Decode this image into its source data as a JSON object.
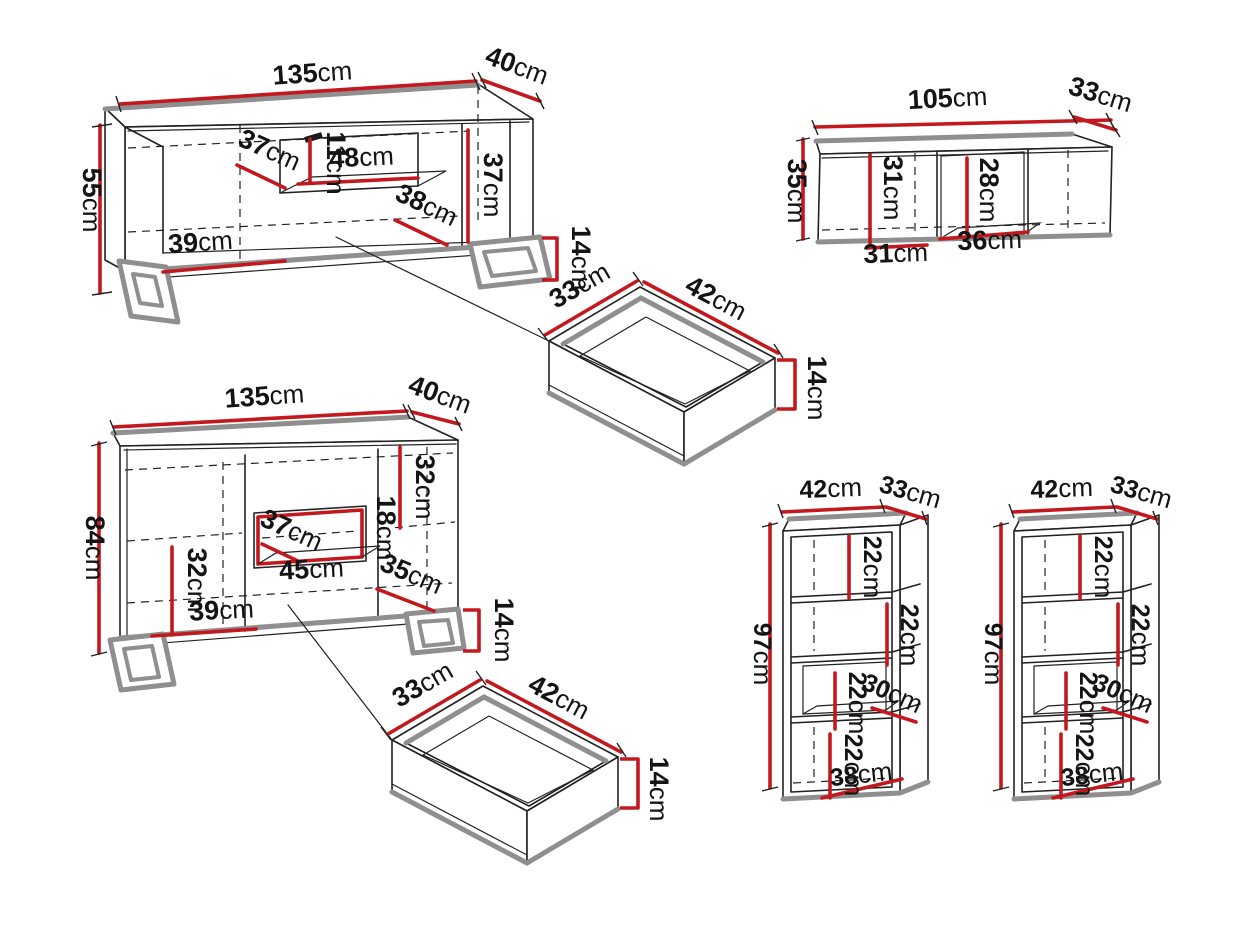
{
  "units": "cm",
  "colors": {
    "dimension_red": "#c3191e",
    "edge_gray": "#8f8f8f",
    "line_black": "#222222",
    "background": "#ffffff"
  },
  "pieces": {
    "tv_stand": {
      "width": "135",
      "depth": "40",
      "height": "55",
      "left_door_width": "37",
      "niche_height": "11",
      "niche_width": "48",
      "right_inner_height": "37",
      "right_door_width": "38",
      "left_inner_width": "39",
      "leg_height": "14"
    },
    "wall_cabinet": {
      "width": "105",
      "depth": "33",
      "height": "35",
      "left_inner_height": "31",
      "middle_inner_height": "28",
      "left_inner_width": "31",
      "middle_inner_width": "36"
    },
    "drawer_top": {
      "depth": "33",
      "width": "42",
      "height": "14"
    },
    "sideboard": {
      "width": "135",
      "depth": "40",
      "height": "84",
      "right_inner_height": "32",
      "niche_height": "18",
      "niche_inner_width": "37",
      "niche_width": "45",
      "right_door_width": "35",
      "left_inner_height": "32",
      "left_inner_width": "39",
      "leg_height": "14"
    },
    "drawer_bottom": {
      "depth": "33",
      "width": "42",
      "height": "14"
    },
    "bookcase_left": {
      "width": "42",
      "depth": "33",
      "height": "97",
      "compartment_1_height": "22",
      "compartment_2_height": "22",
      "compartment_3_height": "22",
      "inner_width": "30",
      "compartment_4_height": "22",
      "bottom_inner_width": "38"
    },
    "bookcase_right": {
      "width": "42",
      "depth": "33",
      "height": "97",
      "compartment_1_height": "22",
      "compartment_2_height": "22",
      "compartment_3_height": "22",
      "inner_width": "30",
      "compartment_4_height": "22",
      "bottom_inner_width": "38"
    }
  }
}
